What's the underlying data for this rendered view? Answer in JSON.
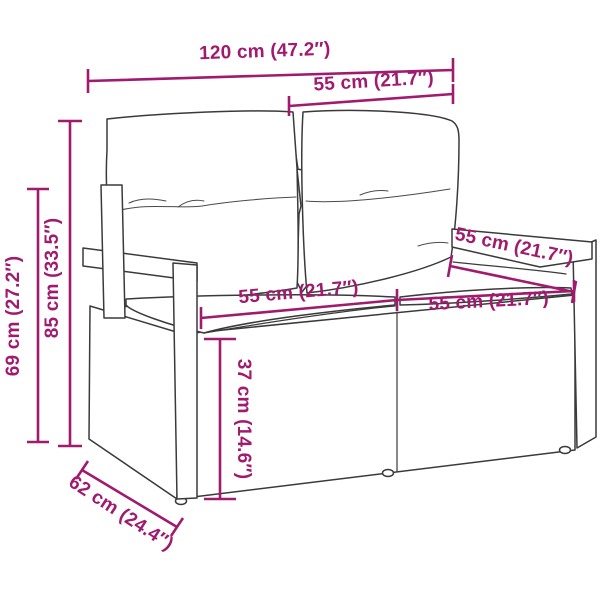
{
  "accent_color": "#A01B6E",
  "diagram": {
    "type": "furniture-dimension-diagram",
    "labels": {
      "overall_width": "120 cm (47.2″)",
      "backrest_width": "55 cm (21.7″)",
      "overall_height": "85 cm (33.5″)",
      "armrest_height": "69 cm (27.2″)",
      "left_seat_width": "55 cm (21.7″)",
      "right_seat_width": "55 cm (21.7″)",
      "armrest_top_depth": "55 cm (21.7″)",
      "seat_height": "37 cm (14.6″)",
      "overall_depth": "62 cm (24.4″)"
    }
  }
}
